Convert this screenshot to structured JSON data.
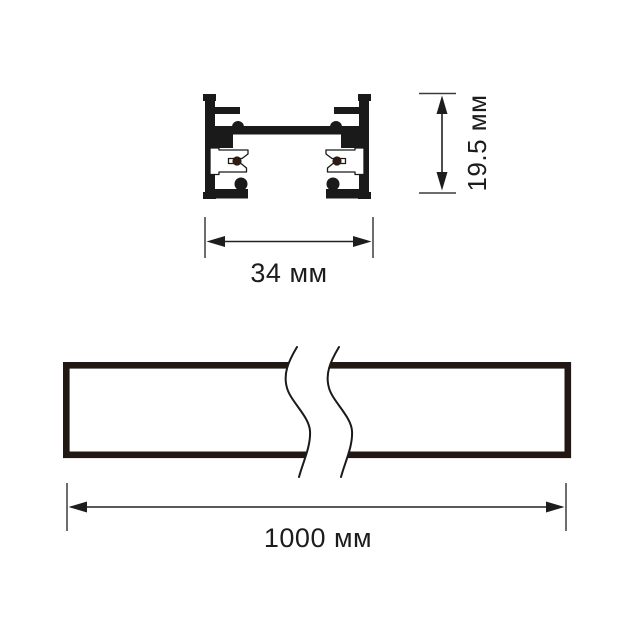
{
  "meta": {
    "type": "technical dimension drawing of a lighting track profile",
    "background": "#ffffff"
  },
  "cross_section": {
    "name": "track profile cross-section",
    "profile_color": "#1a1a1a",
    "conductor_color": "#2e1b12"
  },
  "side_view": {
    "name": "track side view with break lines",
    "outline_color": "#211713"
  },
  "dimensions": {
    "height": {
      "label": "19.5 мм",
      "value": "19.5",
      "unit": "мм"
    },
    "width": {
      "label": "34 мм",
      "value": "34",
      "unit": "мм"
    },
    "length": {
      "label": "1000 мм",
      "value": "1000",
      "unit": "мм"
    }
  }
}
